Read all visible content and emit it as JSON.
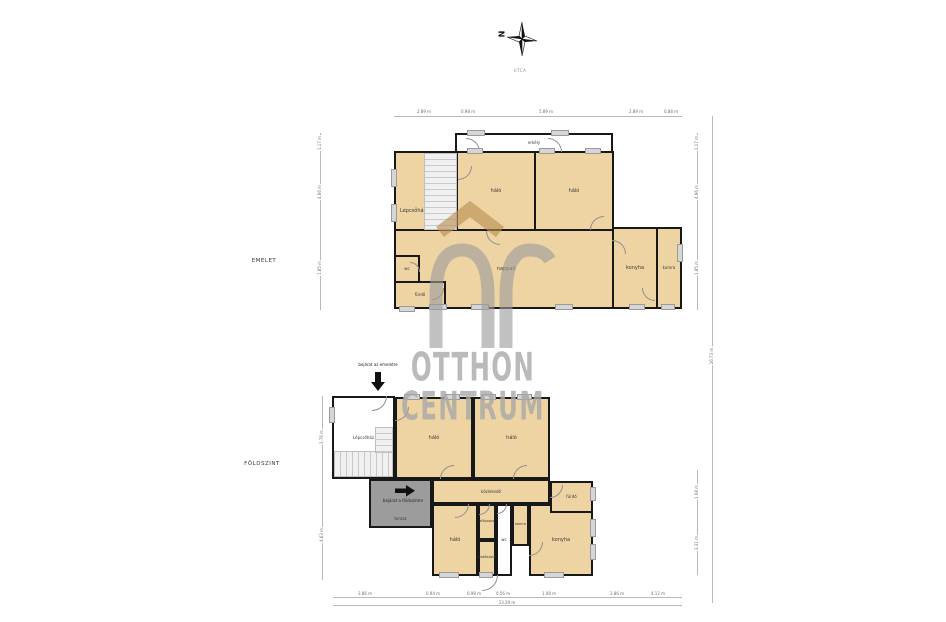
{
  "compass": {
    "letter": "N",
    "street_label": "UTCA"
  },
  "watermark": {
    "logo": "OC",
    "line1": "OTTHON",
    "line2": "CENTRUM",
    "logo_roof_color": "#b98f52",
    "logo_arch_color": "#9c9c9c",
    "text_color": "#a9a9a9"
  },
  "colors": {
    "room_fill": "#eed4a3",
    "wall": "#181818",
    "terrace_fill": "#9c9c9c",
    "window": "#d6d6d6",
    "dimension": "#6e6e6e"
  },
  "floors": [
    {
      "label": "EMELET",
      "rooms": [
        {
          "label": "erkély",
          "fs": 4,
          "x": 455,
          "y": 133,
          "w": 158,
          "h": 20,
          "fill": "white"
        },
        {
          "label": "Lépcsőház",
          "la": "left",
          "x": 394,
          "y": 151,
          "w": 64,
          "h": 120,
          "fill": "tan"
        },
        {
          "label": "háló",
          "x": 456,
          "y": 151,
          "w": 80,
          "h": 80,
          "fill": "tan"
        },
        {
          "label": "háló",
          "x": 534,
          "y": 151,
          "w": 80,
          "h": 80,
          "fill": "tan"
        },
        {
          "label": "nappali",
          "x": 394,
          "y": 229,
          "w": 224,
          "h": 80,
          "fill": "tan"
        },
        {
          "label": "konyha",
          "x": 612,
          "y": 227,
          "w": 46,
          "h": 82,
          "fill": "tan"
        },
        {
          "label": "kamra",
          "fs": 4,
          "x": 656,
          "y": 227,
          "w": 26,
          "h": 82,
          "fill": "tan"
        },
        {
          "label": "wc",
          "fs": 4,
          "x": 394,
          "y": 255,
          "w": 26,
          "h": 28,
          "fill": "tan"
        },
        {
          "label": "fürdő",
          "fs": 4,
          "x": 394,
          "y": 281,
          "w": 52,
          "h": 28,
          "fill": "tan"
        }
      ],
      "stairs": [
        {
          "x": 424,
          "y": 153,
          "w": 33,
          "h": 77,
          "dir": "v"
        }
      ],
      "doors": [
        {
          "x": 466,
          "y": 138,
          "r": 14,
          "q": "tr"
        },
        {
          "x": 548,
          "y": 138,
          "r": 14,
          "q": "tr"
        },
        {
          "x": 486,
          "y": 231,
          "r": 14,
          "q": "bl"
        },
        {
          "x": 590,
          "y": 216,
          "r": 14,
          "q": "tl"
        },
        {
          "x": 458,
          "y": 166,
          "r": 14,
          "q": "br"
        },
        {
          "x": 410,
          "y": 262,
          "r": 10,
          "q": "tr"
        },
        {
          "x": 432,
          "y": 288,
          "r": 12,
          "q": "br"
        },
        {
          "x": 612,
          "y": 240,
          "r": 14,
          "q": "tr"
        },
        {
          "x": 642,
          "y": 288,
          "r": 13,
          "q": "bl"
        }
      ],
      "windows": [
        {
          "x": 468,
          "y": 131,
          "l": 16,
          "o": "h"
        },
        {
          "x": 552,
          "y": 131,
          "l": 16,
          "o": "h"
        },
        {
          "x": 468,
          "y": 149,
          "l": 14,
          "o": "h"
        },
        {
          "x": 540,
          "y": 149,
          "l": 14,
          "o": "h"
        },
        {
          "x": 586,
          "y": 149,
          "l": 14,
          "o": "h"
        },
        {
          "x": 430,
          "y": 305,
          "l": 16,
          "o": "h"
        },
        {
          "x": 472,
          "y": 305,
          "l": 16,
          "o": "h"
        },
        {
          "x": 556,
          "y": 305,
          "l": 16,
          "o": "h"
        },
        {
          "x": 630,
          "y": 305,
          "l": 14,
          "o": "h"
        },
        {
          "x": 662,
          "y": 305,
          "l": 12,
          "o": "h"
        },
        {
          "x": 400,
          "y": 307,
          "l": 14,
          "o": "h"
        },
        {
          "x": 392,
          "y": 170,
          "l": 16,
          "o": "v"
        },
        {
          "x": 392,
          "y": 205,
          "l": 16,
          "o": "v"
        },
        {
          "x": 678,
          "y": 245,
          "l": 16,
          "o": "v"
        }
      ]
    },
    {
      "label": "FÖLDSZINT",
      "annotations": [
        {
          "text": "bejárat az emeletre"
        },
        {
          "text": "bejárat a földszintre"
        }
      ],
      "rooms": [
        {
          "label": "Lépcsőház",
          "fs": 4,
          "x": 332,
          "y": 396,
          "w": 63,
          "h": 83,
          "fill": "white"
        },
        {
          "label": "háló",
          "x": 395,
          "y": 397,
          "w": 78,
          "h": 82,
          "fill": "tan"
        },
        {
          "label": "háló",
          "x": 473,
          "y": 397,
          "w": 77,
          "h": 82,
          "fill": "tan"
        },
        {
          "label": "terasz",
          "fs": 4,
          "la": "bottom",
          "x": 369,
          "y": 479,
          "w": 63,
          "h": 49,
          "fill": "gray"
        },
        {
          "label": "közlekedő",
          "fs": 4,
          "x": 432,
          "y": 479,
          "w": 118,
          "h": 25,
          "fill": "tan"
        },
        {
          "label": "háló",
          "x": 432,
          "y": 504,
          "w": 46,
          "h": 72,
          "fill": "tan"
        },
        {
          "label": "előszoba",
          "fs": 3.5,
          "x": 478,
          "y": 504,
          "w": 18,
          "h": 36,
          "fill": "tan"
        },
        {
          "label": "fürdőszoba",
          "fs": 3.5,
          "x": 478,
          "y": 540,
          "w": 18,
          "h": 36,
          "fill": "tan"
        },
        {
          "label": "wc",
          "fs": 4,
          "x": 496,
          "y": 504,
          "w": 16,
          "h": 72,
          "fill": "white"
        },
        {
          "label": "kamra",
          "fs": 3.5,
          "x": 512,
          "y": 504,
          "w": 17,
          "h": 42,
          "fill": "tan"
        },
        {
          "label": "konyha",
          "x": 529,
          "y": 504,
          "w": 64,
          "h": 72,
          "fill": "tan"
        },
        {
          "label": "fürdő",
          "fs": 4,
          "x": 550,
          "y": 481,
          "w": 43,
          "h": 32,
          "fill": "tan"
        }
      ],
      "stairs": [
        {
          "x": 334,
          "y": 451,
          "w": 59,
          "h": 26,
          "dir": "h"
        },
        {
          "x": 375,
          "y": 427,
          "w": 18,
          "h": 26,
          "dir": "v"
        }
      ],
      "doors": [
        {
          "x": 372,
          "y": 396,
          "r": 15,
          "q": "br"
        },
        {
          "x": 395,
          "y": 407,
          "r": 14,
          "q": "br"
        },
        {
          "x": 440,
          "y": 465,
          "r": 14,
          "q": "tl"
        },
        {
          "x": 513,
          "y": 465,
          "r": 14,
          "q": "tl"
        },
        {
          "x": 550,
          "y": 485,
          "r": 13,
          "q": "br"
        },
        {
          "x": 455,
          "y": 504,
          "r": 14,
          "q": "br"
        },
        {
          "x": 479,
          "y": 504,
          "r": 11,
          "q": "br"
        },
        {
          "x": 497,
          "y": 504,
          "r": 10,
          "q": "br"
        },
        {
          "x": 529,
          "y": 542,
          "r": 14,
          "q": "br"
        },
        {
          "x": 482,
          "y": 575,
          "r": 16,
          "q": "br"
        }
      ],
      "windows": [
        {
          "x": 405,
          "y": 395,
          "l": 14,
          "o": "h"
        },
        {
          "x": 445,
          "y": 395,
          "l": 14,
          "o": "h"
        },
        {
          "x": 482,
          "y": 395,
          "l": 13,
          "o": "h"
        },
        {
          "x": 518,
          "y": 395,
          "l": 13,
          "o": "h"
        },
        {
          "x": 440,
          "y": 573,
          "l": 18,
          "o": "h"
        },
        {
          "x": 480,
          "y": 573,
          "l": 12,
          "o": "h"
        },
        {
          "x": 545,
          "y": 573,
          "l": 18,
          "o": "h"
        },
        {
          "x": 591,
          "y": 488,
          "l": 12,
          "o": "v"
        },
        {
          "x": 591,
          "y": 520,
          "l": 16,
          "o": "v"
        },
        {
          "x": 591,
          "y": 545,
          "l": 14,
          "o": "v"
        },
        {
          "x": 330,
          "y": 408,
          "l": 14,
          "o": "v"
        }
      ]
    }
  ],
  "dimensions": {
    "labels": [
      {
        "t": "2.89 m",
        "x": 424,
        "y": 112
      },
      {
        "t": "0.98 m",
        "x": 468,
        "y": 112
      },
      {
        "t": "5.89 m",
        "x": 546,
        "y": 112
      },
      {
        "t": "2.89 m",
        "x": 636,
        "y": 112
      },
      {
        "t": "0.88 m",
        "x": 671,
        "y": 112
      },
      {
        "t": "1.17 m",
        "x": 697,
        "y": 143,
        "rot": true
      },
      {
        "t": "4.66 m",
        "x": 697,
        "y": 192,
        "rot": true
      },
      {
        "t": "1.85 m",
        "x": 697,
        "y": 268,
        "rot": true
      },
      {
        "t": "26.73 m",
        "x": 712,
        "y": 356,
        "rot": true
      },
      {
        "t": "1.08 m",
        "x": 697,
        "y": 492,
        "rot": true
      },
      {
        "t": "3.31 m",
        "x": 697,
        "y": 543,
        "rot": true
      },
      {
        "t": "1.17 m",
        "x": 320,
        "y": 143,
        "rot": true
      },
      {
        "t": "4.66 m",
        "x": 320,
        "y": 192,
        "rot": true
      },
      {
        "t": "1.85 m",
        "x": 320,
        "y": 268,
        "rot": true
      },
      {
        "t": "3.76 m",
        "x": 322,
        "y": 437,
        "rot": true
      },
      {
        "t": "4.63 m",
        "x": 322,
        "y": 535,
        "rot": true
      },
      {
        "t": "3.86 m",
        "x": 365,
        "y": 594
      },
      {
        "t": "0.94 m",
        "x": 433,
        "y": 594
      },
      {
        "t": "0.98 m",
        "x": 474,
        "y": 594
      },
      {
        "t": "0.56 m",
        "x": 503,
        "y": 594
      },
      {
        "t": "1.08 m",
        "x": 549,
        "y": 594
      },
      {
        "t": "2.86 m",
        "x": 617,
        "y": 594
      },
      {
        "t": "4.12 m",
        "x": 658,
        "y": 594
      },
      {
        "t": "13.29 m",
        "x": 507,
        "y": 603
      }
    ],
    "lines": [
      {
        "x": 394,
        "y": 116,
        "w": 288,
        "h": 1
      },
      {
        "x": 697,
        "y": 133,
        "w": 1,
        "h": 177
      },
      {
        "x": 712,
        "y": 116,
        "w": 1,
        "h": 487
      },
      {
        "x": 320,
        "y": 133,
        "w": 1,
        "h": 177
      },
      {
        "x": 322,
        "y": 396,
        "w": 1,
        "h": 184
      },
      {
        "x": 697,
        "y": 470,
        "w": 1,
        "h": 105
      },
      {
        "x": 333,
        "y": 597,
        "w": 349,
        "h": 1
      },
      {
        "x": 333,
        "y": 605,
        "w": 349,
        "h": 1
      }
    ]
  }
}
